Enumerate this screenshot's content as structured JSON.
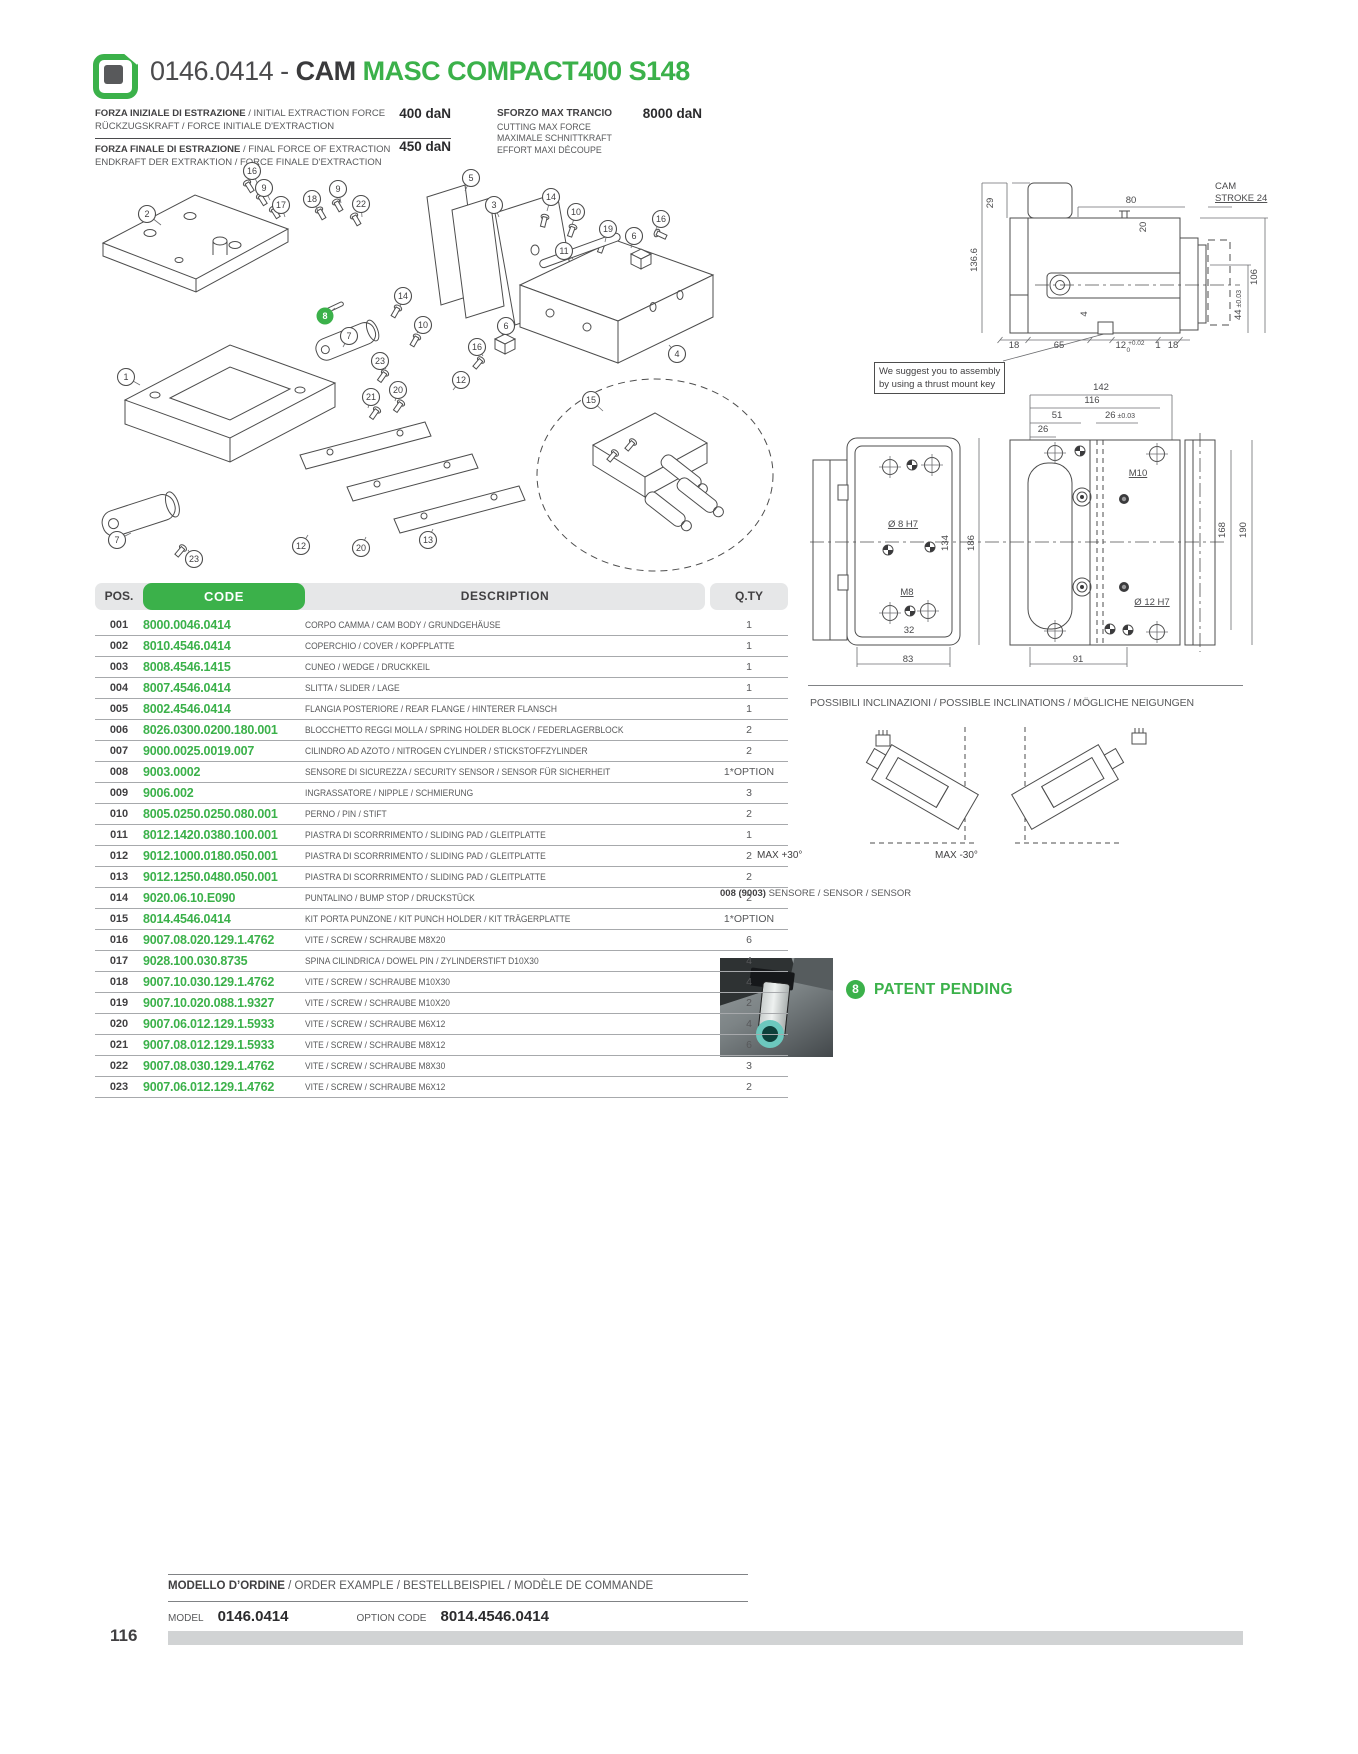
{
  "page": {
    "number": "116"
  },
  "header": {
    "code": "0146.0414 -",
    "product": "CAM",
    "series": "MASC COMPACT400 S148"
  },
  "specs": {
    "initial_force": {
      "label_it": "FORZA INIZIALE DI ESTRAZIONE",
      "label_en": " / INITIAL EXTRACTION FORCE",
      "label_de_fr": "RÜCKZUGSKRAFT / FORCE INITIALE D'EXTRACTION",
      "value": "400 daN"
    },
    "final_force": {
      "label_it": "FORZA FINALE DI ESTRAZIONE",
      "label_en": " / FINAL FORCE OF EXTRACTION",
      "label_de_fr": "ENDKRAFT DER EXTRAKTION / FORCE FINALE D'EXTRACTION",
      "value": "450 daN"
    },
    "cutting_force": {
      "label_it": "SFORZO MAX TRANCIO",
      "value": "8000 daN",
      "label_en": "CUTTING MAX FORCE",
      "label_de": "MAXIMALE SCHNITTKRAFT",
      "label_fr": "EFFORT MAXI DÉCOUPE"
    }
  },
  "assembly_note": {
    "line1": "We suggest you to assembly",
    "line2": "by using a thrust mount key"
  },
  "exploded": {
    "balloons": [
      {
        "n": "2",
        "x": 52,
        "y": 59,
        "lx": 66,
        "ly": 70
      },
      {
        "n": "16",
        "x": 157,
        "y": 16,
        "lx": 163,
        "ly": 30
      },
      {
        "n": "9",
        "x": 169,
        "y": 33,
        "lx": 175,
        "ly": 45
      },
      {
        "n": "17",
        "x": 186,
        "y": 50,
        "lx": 190,
        "ly": 62
      },
      {
        "n": "18",
        "x": 217,
        "y": 44,
        "lx": 223,
        "ly": 56
      },
      {
        "n": "9",
        "x": 243,
        "y": 34,
        "lx": 246,
        "ly": 48
      },
      {
        "n": "22",
        "x": 266,
        "y": 49,
        "lx": 267,
        "ly": 62
      },
      {
        "n": "5",
        "x": 376,
        "y": 23,
        "lx": 370,
        "ly": 36
      },
      {
        "n": "3",
        "x": 399,
        "y": 50,
        "lx": 404,
        "ly": 62
      },
      {
        "n": "14",
        "x": 456,
        "y": 42,
        "lx": 452,
        "ly": 56
      },
      {
        "n": "10",
        "x": 481,
        "y": 57,
        "lx": 477,
        "ly": 70
      },
      {
        "n": "19",
        "x": 513,
        "y": 74,
        "lx": 510,
        "ly": 87
      },
      {
        "n": "6",
        "x": 539,
        "y": 81,
        "lx": 536,
        "ly": 93
      },
      {
        "n": "16",
        "x": 566,
        "y": 64,
        "lx": 560,
        "ly": 76
      },
      {
        "n": "11",
        "x": 469,
        "y": 96,
        "lx": 478,
        "ly": 104
      },
      {
        "n": "8",
        "x": 230,
        "y": 161,
        "lx": 240,
        "ly": 153,
        "g": 1
      },
      {
        "n": "14",
        "x": 308,
        "y": 141,
        "lx": 305,
        "ly": 152
      },
      {
        "n": "10",
        "x": 328,
        "y": 170,
        "lx": 322,
        "ly": 178
      },
      {
        "n": "7",
        "x": 254,
        "y": 181,
        "lx": 248,
        "ly": 192
      },
      {
        "n": "6",
        "x": 411,
        "y": 171,
        "lx": 407,
        "ly": 180
      },
      {
        "n": "16",
        "x": 382,
        "y": 192,
        "lx": 388,
        "ly": 201
      },
      {
        "n": "23",
        "x": 285,
        "y": 206,
        "lx": 291,
        "ly": 214
      },
      {
        "n": "12",
        "x": 366,
        "y": 225,
        "lx": 358,
        "ly": 235
      },
      {
        "n": "20",
        "x": 303,
        "y": 235,
        "lx": 300,
        "ly": 246
      },
      {
        "n": "21",
        "x": 276,
        "y": 242,
        "lx": 273,
        "ly": 253
      },
      {
        "n": "1",
        "x": 31,
        "y": 222,
        "lx": 45,
        "ly": 230
      },
      {
        "n": "15",
        "x": 496,
        "y": 245,
        "lx": 508,
        "ly": 256
      },
      {
        "n": "4",
        "x": 582,
        "y": 199,
        "lx": 574,
        "ly": 190
      },
      {
        "n": "7",
        "x": 22,
        "y": 385,
        "lx": 36,
        "ly": 378
      },
      {
        "n": "23",
        "x": 99,
        "y": 404,
        "lx": 93,
        "ly": 395
      },
      {
        "n": "12",
        "x": 206,
        "y": 391,
        "lx": 213,
        "ly": 380
      },
      {
        "n": "20",
        "x": 266,
        "y": 393,
        "lx": 271,
        "ly": 382
      },
      {
        "n": "13",
        "x": 333,
        "y": 385,
        "lx": 338,
        "ly": 374
      }
    ]
  },
  "drawings": {
    "side_view": {
      "dims": [
        {
          "t": "29",
          "x": 233,
          "y": 48,
          "r": 1
        },
        {
          "t": "136.6",
          "x": 217,
          "y": 105,
          "r": 1
        },
        {
          "t": "80",
          "x": 371,
          "y": 48
        },
        {
          "t": "20",
          "x": 386,
          "y": 72,
          "r": 1
        },
        {
          "t": "CAM",
          "x": 455,
          "y": 34,
          "a": "s"
        },
        {
          "t": "STROKE 24",
          "x": 455,
          "y": 46,
          "a": "s",
          "u": 1
        },
        {
          "t": "106",
          "x": 497,
          "y": 122,
          "r": 1
        },
        {
          "t": "44",
          "tol": [
            "±0.03"
          ],
          "x": 481,
          "y": 150,
          "r": 1
        },
        {
          "t": "4",
          "x": 327,
          "y": 159,
          "r": 1
        },
        {
          "t": "18",
          "x": 254,
          "y": 193
        },
        {
          "t": "65",
          "x": 299,
          "y": 193
        },
        {
          "t": "12",
          "tol": [
            "+0.02",
            "0"
          ],
          "x": 370,
          "y": 193
        },
        {
          "t": "1",
          "x": 398,
          "y": 193
        },
        {
          "t": "18",
          "x": 413,
          "y": 193
        }
      ]
    },
    "front_view": {
      "dims": [
        {
          "t": "142",
          "x": 341,
          "y": 15
        },
        {
          "t": "116",
          "x": 332,
          "y": 28
        },
        {
          "t": "51",
          "x": 297,
          "y": 43
        },
        {
          "t": "26",
          "tol": [
            "±0.03"
          ],
          "x": 360,
          "y": 43
        },
        {
          "t": "26",
          "x": 283,
          "y": 57
        },
        {
          "t": "M10",
          "x": 378,
          "y": 101,
          "u": 1
        },
        {
          "t": "Ø 8 H7",
          "x": 143,
          "y": 152,
          "u": 1
        },
        {
          "t": "134",
          "x": 188,
          "y": 168,
          "r": 1
        },
        {
          "t": "186",
          "x": 214,
          "y": 168,
          "r": 1
        },
        {
          "t": "M8",
          "x": 147,
          "y": 220,
          "u": 1
        },
        {
          "t": "32",
          "x": 149,
          "y": 258
        },
        {
          "t": "83",
          "x": 148,
          "y": 287
        },
        {
          "t": "91",
          "x": 318,
          "y": 287
        },
        {
          "t": "Ø 12 H7",
          "x": 392,
          "y": 230,
          "u": 1
        },
        {
          "t": "168",
          "x": 465,
          "y": 155,
          "r": 1
        },
        {
          "t": "190",
          "x": 486,
          "y": 155,
          "r": 1
        }
      ]
    }
  },
  "inclinations": {
    "heading": "POSSIBILI INCLINAZIONI / POSSIBLE INCLINATIONS / MÖGLICHE NEIGUNGEN",
    "left_label": "MAX +30°",
    "right_label": "MAX -30°"
  },
  "sensor": {
    "pos_bold": "008 (9003)",
    "label": " SENSORE / SENSOR / SENSOR",
    "patent_badge": "8",
    "patent_text": "PATENT PENDING"
  },
  "table": {
    "headers": {
      "pos": "POS.",
      "code": "CODE",
      "description": "DESCRIPTION",
      "qty": "Q.TY"
    },
    "rows": [
      [
        "001",
        "8000.0046.0414",
        "CORPO CAMMA / CAM BODY / GRUNDGEHÄUSE",
        "1"
      ],
      [
        "002",
        "8010.4546.0414",
        "COPERCHIO / COVER / KOPFPLATTE",
        "1"
      ],
      [
        "003",
        "8008.4546.1415",
        "CUNEO / WEDGE / DRUCKKEIL",
        "1"
      ],
      [
        "004",
        "8007.4546.0414",
        "SLITTA / SLIDER / LAGE",
        "1"
      ],
      [
        "005",
        "8002.4546.0414",
        "FLANGIA POSTERIORE / REAR FLANGE / HINTERER FLANSCH",
        "1"
      ],
      [
        "006",
        "8026.0300.0200.180.001",
        "BLOCCHETTO REGGI MOLLA / SPRING HOLDER BLOCK / FEDERLAGERBLOCK",
        "2"
      ],
      [
        "007",
        "9000.0025.0019.007",
        "CILINDRO AD AZOTO / NITROGEN CYLINDER / STICKSTOFFZYLINDER",
        "2"
      ],
      [
        "008",
        "9003.0002",
        "SENSORE DI SICUREZZA / SECURITY SENSOR / SENSOR FÜR SICHERHEIT",
        "1*OPTION"
      ],
      [
        "009",
        "9006.002",
        "INGRASSATORE / NIPPLE / SCHMIERUNG",
        "3"
      ],
      [
        "010",
        "8005.0250.0250.080.001",
        "PERNO / PIN / STIFT",
        "2"
      ],
      [
        "011",
        "8012.1420.0380.100.001",
        "PIASTRA DI SCORRRIMENTO / SLIDING PAD / GLEITPLATTE",
        "1"
      ],
      [
        "012",
        "9012.1000.0180.050.001",
        "PIASTRA DI SCORRRIMENTO / SLIDING PAD / GLEITPLATTE",
        "2"
      ],
      [
        "013",
        "9012.1250.0480.050.001",
        "PIASTRA DI SCORRRIMENTO / SLIDING PAD / GLEITPLATTE",
        "2"
      ],
      [
        "014",
        "9020.06.10.E090",
        "PUNTALINO / BUMP STOP / DRUCKSTÜCK",
        "2"
      ],
      [
        "015",
        "8014.4546.0414",
        "KIT PORTA PUNZONE / KIT PUNCH HOLDER / KIT TRÄGERPLATTE",
        "1*OPTION"
      ],
      [
        "016",
        "9007.08.020.129.1.4762",
        "VITE / SCREW / SCHRAUBE M8X20",
        "6"
      ],
      [
        "017",
        "9028.100.030.8735",
        "SPINA CILINDRICA / DOWEL PIN / ZYLINDERSTIFT D10X30",
        "4"
      ],
      [
        "018",
        "9007.10.030.129.1.4762",
        "VITE / SCREW / SCHRAUBE M10X30",
        "4"
      ],
      [
        "019",
        "9007.10.020.088.1.9327",
        "VITE / SCREW / SCHRAUBE M10X20",
        "2"
      ],
      [
        "020",
        "9007.06.012.129.1.5933",
        "VITE / SCREW / SCHRAUBE M6X12",
        "4"
      ],
      [
        "021",
        "9007.08.012.129.1.5933",
        "VITE / SCREW / SCHRAUBE M8X12",
        "6"
      ],
      [
        "022",
        "9007.08.030.129.1.4762",
        "VITE / SCREW / SCHRAUBE M8X30",
        "3"
      ],
      [
        "023",
        "9007.06.012.129.1.4762",
        "VITE / SCREW / SCHRAUBE M6X12",
        "2"
      ]
    ]
  },
  "footer": {
    "order_bold": "MODELLO D’ORDINE",
    "order_rest": " / ORDER EXAMPLE / BESTELLBEISPIEL / MODÈLE DE COMMANDE",
    "model_label": "MODEL",
    "model_value": "0146.0414",
    "option_label": "OPTION CODE",
    "option_value": "8014.4546.0414"
  },
  "colors": {
    "green": "#3BB14A",
    "dark": "#414042",
    "gray": "#58595B"
  }
}
